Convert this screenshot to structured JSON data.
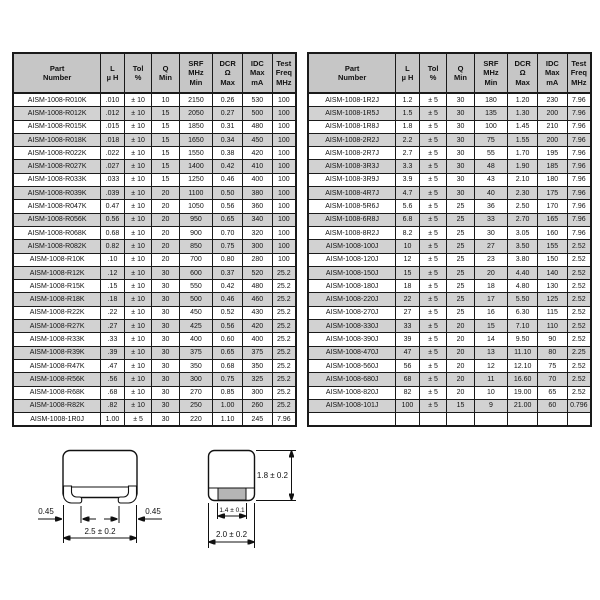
{
  "columns": [
    {
      "label": "Part\nNumber"
    },
    {
      "label": "L\nµ H"
    },
    {
      "label": "Tol\n%"
    },
    {
      "label": "Q\nMin"
    },
    {
      "label": "SRF\nMHz\nMin"
    },
    {
      "label": "DCR\nΩ\nMax"
    },
    {
      "label": "IDC\nMax\nmA"
    },
    {
      "label": "Test\nFreq\nMHz"
    }
  ],
  "left_table": {
    "rows": [
      [
        "AISM-1008-R010K",
        ".010",
        "± 10",
        "10",
        "2150",
        "0.26",
        "530",
        "100"
      ],
      [
        "AISM-1008-R012K",
        ".012",
        "± 10",
        "15",
        "2050",
        "0.27",
        "500",
        "100"
      ],
      [
        "AISM-1008-R015K",
        ".015",
        "± 10",
        "15",
        "1850",
        "0.31",
        "480",
        "100"
      ],
      [
        "AISM-1008-R018K",
        ".018",
        "± 10",
        "15",
        "1650",
        "0.34",
        "450",
        "100"
      ],
      [
        "AISM-1008-R022K",
        ".022",
        "± 10",
        "15",
        "1550",
        "0.38",
        "420",
        "100"
      ],
      [
        "AISM-1008-R027K",
        ".027",
        "± 10",
        "15",
        "1400",
        "0.42",
        "410",
        "100"
      ],
      [
        "AISM-1008-R033K",
        ".033",
        "± 10",
        "15",
        "1250",
        "0.46",
        "400",
        "100"
      ],
      [
        "AISM-1008-R039K",
        ".039",
        "± 10",
        "20",
        "1100",
        "0.50",
        "380",
        "100"
      ],
      [
        "AISM-1008-R047K",
        "0.47",
        "± 10",
        "20",
        "1050",
        "0.56",
        "360",
        "100"
      ],
      [
        "AISM-1008-R056K",
        "0.56",
        "± 10",
        "20",
        "950",
        "0.65",
        "340",
        "100"
      ],
      [
        "AISM-1008-R068K",
        "0.68",
        "± 10",
        "20",
        "900",
        "0.70",
        "320",
        "100"
      ],
      [
        "AISM-1008-R082K",
        "0.82",
        "± 10",
        "20",
        "850",
        "0.75",
        "300",
        "100"
      ],
      [
        "AISM-1008-R10K",
        ".10",
        "± 10",
        "20",
        "700",
        "0.80",
        "280",
        "100"
      ],
      [
        "AISM-1008-R12K",
        ".12",
        "± 10",
        "30",
        "600",
        "0.37",
        "520",
        "25.2"
      ],
      [
        "AISM-1008-R15K",
        ".15",
        "± 10",
        "30",
        "550",
        "0.42",
        "480",
        "25.2"
      ],
      [
        "AISM-1008-R18K",
        ".18",
        "± 10",
        "30",
        "500",
        "0.46",
        "460",
        "25.2"
      ],
      [
        "AISM-1008-R22K",
        ".22",
        "± 10",
        "30",
        "450",
        "0.52",
        "430",
        "25.2"
      ],
      [
        "AISM-1008-R27K",
        ".27",
        "± 10",
        "30",
        "425",
        "0.56",
        "420",
        "25.2"
      ],
      [
        "AISM-1008-R33K",
        ".33",
        "± 10",
        "30",
        "400",
        "0.60",
        "400",
        "25.2"
      ],
      [
        "AISM-1008-R39K",
        ".39",
        "± 10",
        "30",
        "375",
        "0.65",
        "375",
        "25.2"
      ],
      [
        "AISM-1008-R47K",
        ".47",
        "± 10",
        "30",
        "350",
        "0.68",
        "350",
        "25.2"
      ],
      [
        "AISM-1008-R56K",
        ".56",
        "± 10",
        "30",
        "300",
        "0.75",
        "325",
        "25.2"
      ],
      [
        "AISM-1008-R68K",
        ".68",
        "± 10",
        "30",
        "270",
        "0.85",
        "300",
        "25.2"
      ],
      [
        "AISM-1008-R82K",
        ".82",
        "± 10",
        "30",
        "250",
        "1.00",
        "260",
        "25.2"
      ],
      [
        "AISM-1008-1R0J",
        "1.00",
        "± 5",
        "30",
        "220",
        "1.10",
        "245",
        "7.96"
      ]
    ]
  },
  "right_table": {
    "rows": [
      [
        "AISM-1008-1R2J",
        "1.2",
        "± 5",
        "30",
        "180",
        "1.20",
        "230",
        "7.96"
      ],
      [
        "AISM-1008-1R5J",
        "1.5",
        "± 5",
        "30",
        "135",
        "1.30",
        "200",
        "7.96"
      ],
      [
        "AISM-1008-1R8J",
        "1.8",
        "± 5",
        "30",
        "100",
        "1.45",
        "210",
        "7.96"
      ],
      [
        "AISM-1008-2R2J",
        "2.2",
        "± 5",
        "30",
        "75",
        "1.55",
        "200",
        "7.96"
      ],
      [
        "AISM-1008-2R7J",
        "2.7",
        "± 5",
        "30",
        "55",
        "1.70",
        "195",
        "7.96"
      ],
      [
        "AISM-1008-3R3J",
        "3.3",
        "± 5",
        "30",
        "48",
        "1.90",
        "185",
        "7.96"
      ],
      [
        "AISM-1008-3R9J",
        "3.9",
        "± 5",
        "30",
        "43",
        "2.10",
        "180",
        "7.96"
      ],
      [
        "AISM-1008-4R7J",
        "4.7",
        "± 5",
        "30",
        "40",
        "2.30",
        "175",
        "7.96"
      ],
      [
        "AISM-1008-5R6J",
        "5.6",
        "± 5",
        "25",
        "36",
        "2.50",
        "170",
        "7.96"
      ],
      [
        "AISM-1008-6R8J",
        "6.8",
        "± 5",
        "25",
        "33",
        "2.70",
        "165",
        "7.96"
      ],
      [
        "AISM-1008-8R2J",
        "8.2",
        "± 5",
        "25",
        "30",
        "3.05",
        "160",
        "7.96"
      ],
      [
        "AISM-1008-100J",
        "10",
        "± 5",
        "25",
        "27",
        "3.50",
        "155",
        "2.52"
      ],
      [
        "AISM-1008-120J",
        "12",
        "± 5",
        "25",
        "23",
        "3.80",
        "150",
        "2.52"
      ],
      [
        "AISM-1008-150J",
        "15",
        "± 5",
        "25",
        "20",
        "4.40",
        "140",
        "2.52"
      ],
      [
        "AISM-1008-180J",
        "18",
        "± 5",
        "25",
        "18",
        "4.80",
        "130",
        "2.52"
      ],
      [
        "AISM-1008-220J",
        "22",
        "± 5",
        "25",
        "17",
        "5.50",
        "125",
        "2.52"
      ],
      [
        "AISM-1008-270J",
        "27",
        "± 5",
        "25",
        "16",
        "6.30",
        "115",
        "2.52"
      ],
      [
        "AISM-1008-330J",
        "33",
        "± 5",
        "20",
        "15",
        "7.10",
        "110",
        "2.52"
      ],
      [
        "AISM-1008-390J",
        "39",
        "± 5",
        "20",
        "14",
        "9.50",
        "90",
        "2.52"
      ],
      [
        "AISM-1008-470J",
        "47",
        "± 5",
        "20",
        "13",
        "11.10",
        "80",
        "2.25"
      ],
      [
        "AISM-1008-560J",
        "56",
        "± 5",
        "20",
        "12",
        "12.10",
        "75",
        "2.52"
      ],
      [
        "AISM-1008-680J",
        "68",
        "± 5",
        "20",
        "11",
        "16.60",
        "70",
        "2.52"
      ],
      [
        "AISM-1008-820J",
        "82",
        "± 5",
        "20",
        "10",
        "19.00",
        "65",
        "2.52"
      ],
      [
        "AISM-1008-101J",
        "100",
        "± 5",
        "15",
        "9",
        "21.00",
        "60",
        "0.796"
      ],
      [
        "",
        "",
        "",
        "",
        "",
        "",
        "",
        ""
      ]
    ]
  },
  "drawings": {
    "front_view": {
      "left_lead": "0.45",
      "right_lead": "0.45",
      "width": "2.5 ± 0.2"
    },
    "side_view": {
      "height": "1.8 ± 0.2",
      "terminal": "1.4 ± 0.1",
      "width": "2.0 ± 0.2"
    }
  },
  "colors": {
    "page_bg": "#ffffff",
    "header_bg": "#c6c6c6",
    "row_alt_bg": "#d2d2d2",
    "border": "#1a1a1a",
    "terminal_fill": "#b5b5b5"
  }
}
